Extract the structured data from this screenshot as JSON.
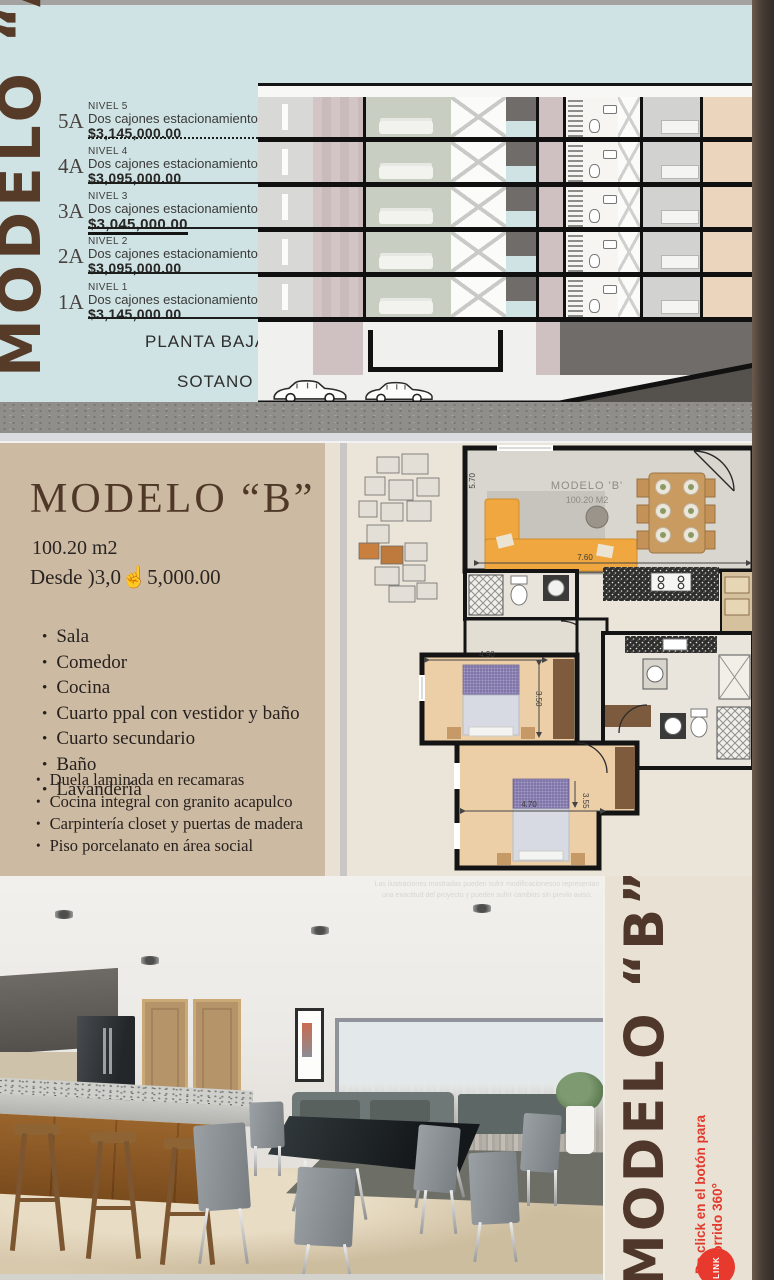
{
  "colors": {
    "brand_brown": "#563b28",
    "accent_red": "#e8392f",
    "section_a_bg": "#cfe2e4",
    "section_b_bg": "#cdbaa3",
    "sidebar_bg": "#e9e1d3"
  },
  "model_a": {
    "title": "MODELO “A”",
    "levels": [
      {
        "code": "5A",
        "level": "NIVEL 5",
        "desc": "Dos cajones estacionamiento",
        "price": "$3,145,000.00"
      },
      {
        "code": "4A",
        "level": "NIVEL 4",
        "desc": "Dos cajones estacionamiento",
        "price": "$3,095,000.00"
      },
      {
        "code": "3A",
        "level": "NIVEL 3",
        "desc": "Dos cajones estacionamiento",
        "price": "$3,045,000.00"
      },
      {
        "code": "2A",
        "level": "NIVEL 2",
        "desc": "Dos cajones estacionamiento",
        "price": "$3,095,000.00"
      },
      {
        "code": "1A",
        "level": "NIVEL 1",
        "desc": "Dos cajones estacionamiento",
        "price": "$3,145,000.00"
      }
    ],
    "planta_baja_label": "PLANTA BAJA",
    "sotano_label": "SOTANO"
  },
  "model_b": {
    "title": "MODELO “B”",
    "area": "100.20 m2",
    "price_line": "Desde  )3,0☝5,000.00",
    "features": [
      "Sala",
      "Comedor",
      "Cocina",
      "Cuarto ppal con vestidor y baño",
      "Cuarto secundario",
      "Baño",
      "Lavandería"
    ],
    "finishes": [
      "Duela laminada en recamaras",
      "Cocina integral con granito acapulco",
      "Carpintería closet y puertas de madera",
      "Piso porcelanato en área social"
    ]
  },
  "floor_plan": {
    "title": "MODELO 'B'",
    "subtitle": "100.20 M2",
    "dims": {
      "living_w": "7.60",
      "living_h": "5.70",
      "bed1_w": "4.90",
      "bed1_h": "3.50",
      "bed2_w": "4.70",
      "bed2_h": "3.55"
    }
  },
  "photo": {
    "disclaimer_line1": "Las ilustraciones mostradas pueden sufrir modificacionesno representan",
    "disclaimer_line2": "una exactitud del proyecto y pueden sufrir cambios sin previo aviso."
  },
  "sidebar": {
    "title": "MODELO “B”",
    "cta": "Da click en el botón para recorrido 360°",
    "link_button": "LINK"
  }
}
